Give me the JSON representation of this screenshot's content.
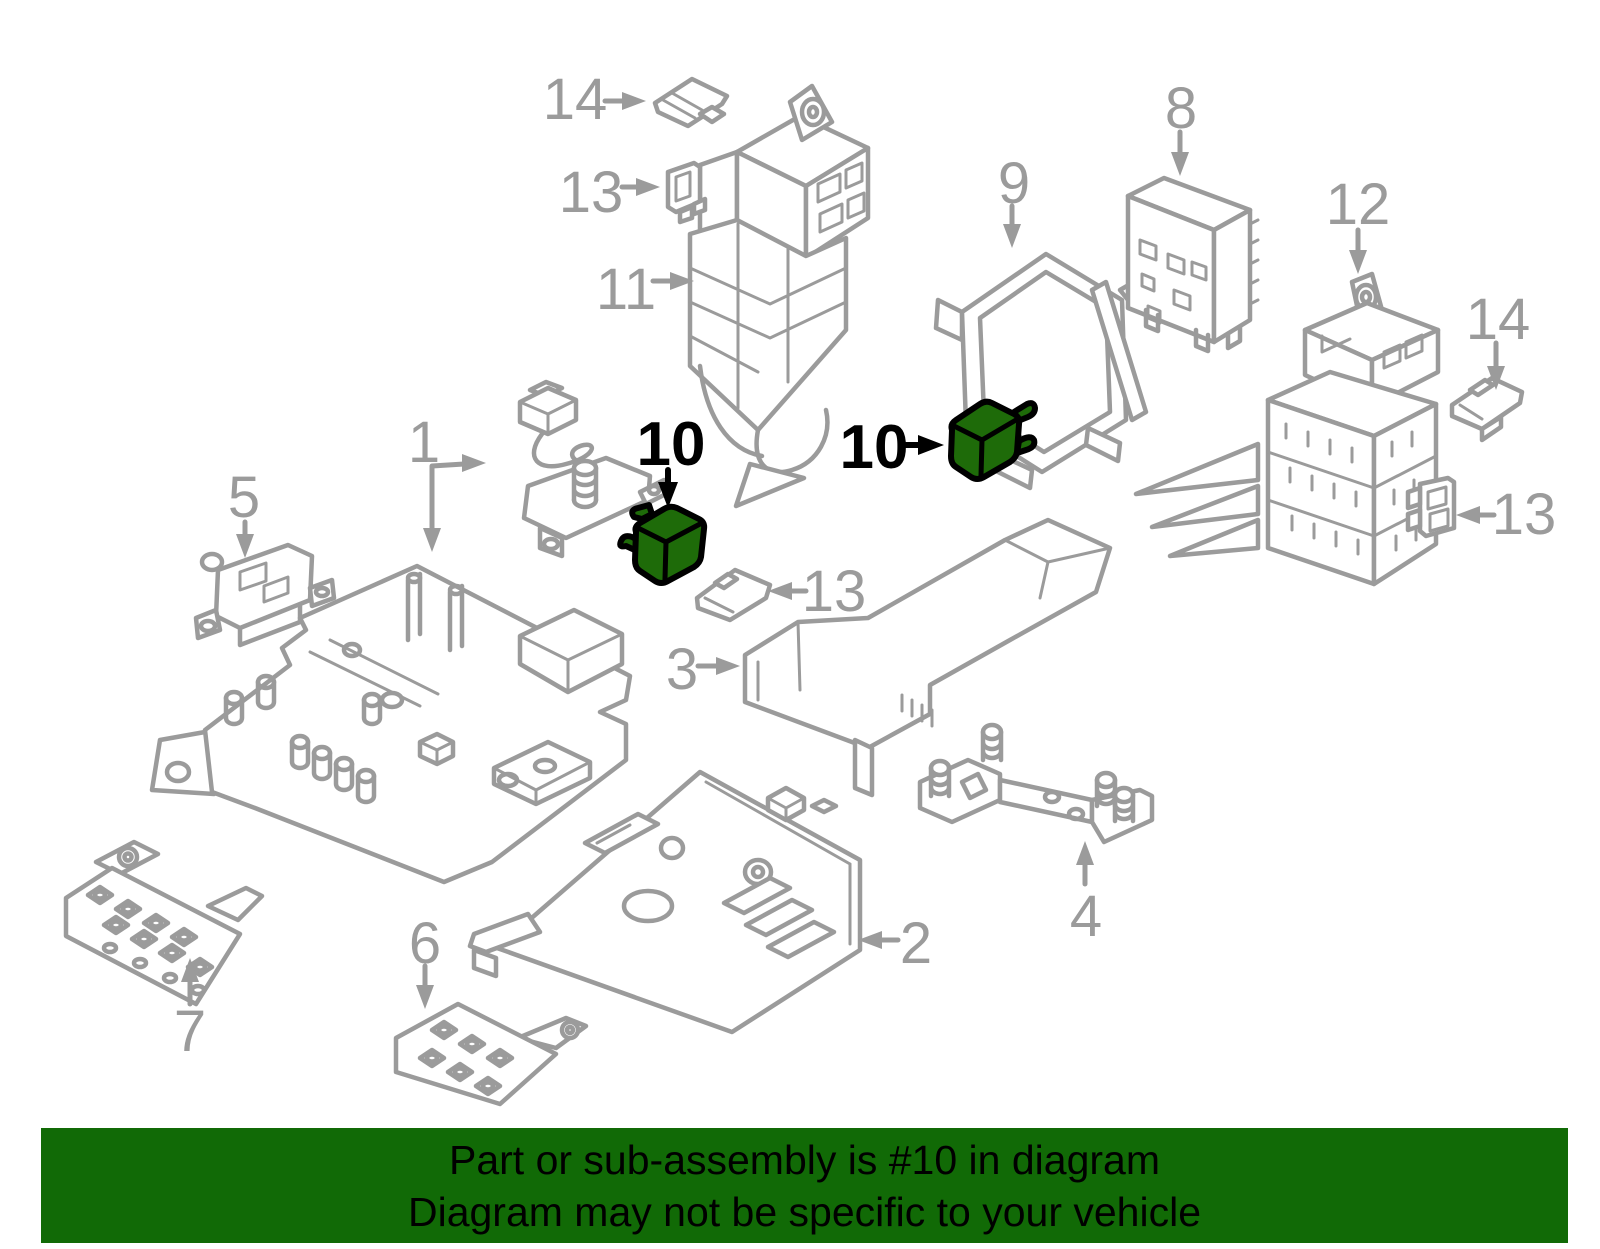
{
  "banner": {
    "line1": "Part or sub-assembly is #10 in diagram",
    "line2": "Diagram may not be specific to your vehicle",
    "background_color": "#116a06",
    "text_color": "#000000"
  },
  "colors": {
    "diagram_line_gray": "#9b9b9b",
    "highlight_green": "#1e6b09",
    "highlight_outline": "#000000"
  },
  "highlighted_part_number": "10",
  "callouts": [
    {
      "id": "14-top",
      "number": "14",
      "color": "gray"
    },
    {
      "id": "13-top",
      "number": "13",
      "color": "gray"
    },
    {
      "id": "11",
      "number": "11",
      "color": "gray"
    },
    {
      "id": "9",
      "number": "9",
      "color": "gray"
    },
    {
      "id": "8",
      "number": "8",
      "color": "gray"
    },
    {
      "id": "12",
      "number": "12",
      "color": "gray"
    },
    {
      "id": "14-right",
      "number": "14",
      "color": "gray"
    },
    {
      "id": "13-right",
      "number": "13",
      "color": "gray"
    },
    {
      "id": "10-left",
      "number": "10",
      "color": "black",
      "highlighted": true
    },
    {
      "id": "10-right",
      "number": "10",
      "color": "black",
      "highlighted": true
    },
    {
      "id": "13-middle",
      "number": "13",
      "color": "gray"
    },
    {
      "id": "3",
      "number": "3",
      "color": "gray"
    },
    {
      "id": "1",
      "number": "1",
      "color": "gray"
    },
    {
      "id": "5",
      "number": "5",
      "color": "gray"
    },
    {
      "id": "7",
      "number": "7",
      "color": "gray"
    },
    {
      "id": "6",
      "number": "6",
      "color": "gray"
    },
    {
      "id": "2",
      "number": "2",
      "color": "gray"
    },
    {
      "id": "4",
      "number": "4",
      "color": "gray"
    }
  ]
}
